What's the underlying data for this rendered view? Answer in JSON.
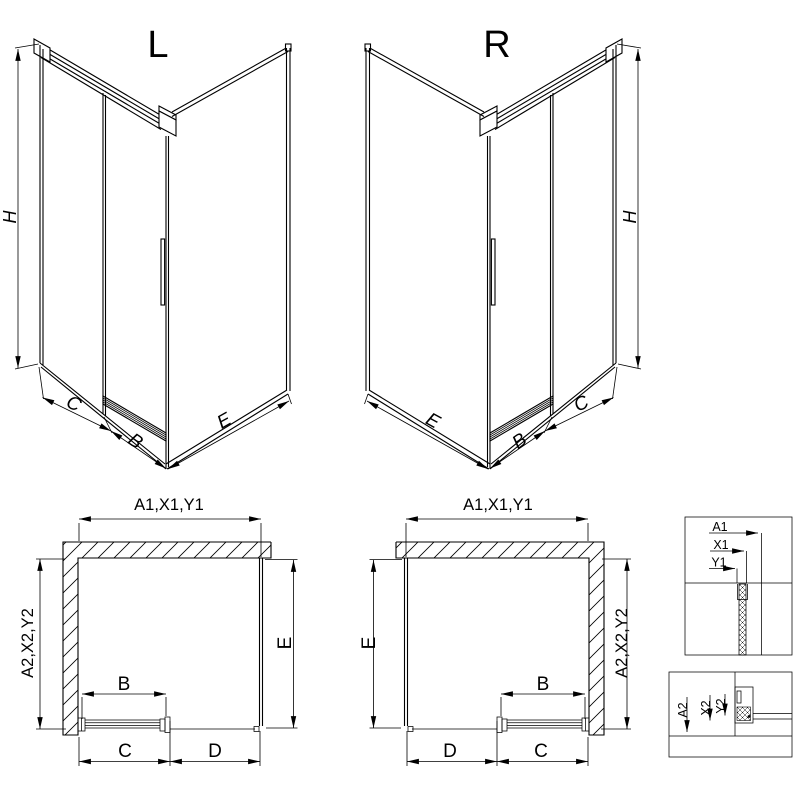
{
  "view_l": {
    "label": "L",
    "dim_h": "H",
    "dim_c": "C",
    "dim_b": "B",
    "dim_e": "E"
  },
  "view_r": {
    "label": "R",
    "dim_h": "H",
    "dim_c": "C",
    "dim_b": "B",
    "dim_e": "E"
  },
  "plan_l": {
    "dim_top": "A1,X1,Y1",
    "dim_side": "A2,X2,Y2",
    "dim_e": "E",
    "dim_b": "B",
    "dim_c": "C",
    "dim_d": "D"
  },
  "plan_r": {
    "dim_top": "A1,X1,Y1",
    "dim_side": "A2,X2,Y2",
    "dim_e": "E",
    "dim_b": "B",
    "dim_c": "C",
    "dim_d": "D"
  },
  "detail_top": {
    "l1": "A1",
    "l2": "X1",
    "l3": "Y1"
  },
  "detail_bottom": {
    "l1": "A2",
    "l2": "X2",
    "l3": "Y2"
  },
  "colors": {
    "line": "#000000",
    "background": "#ffffff"
  }
}
